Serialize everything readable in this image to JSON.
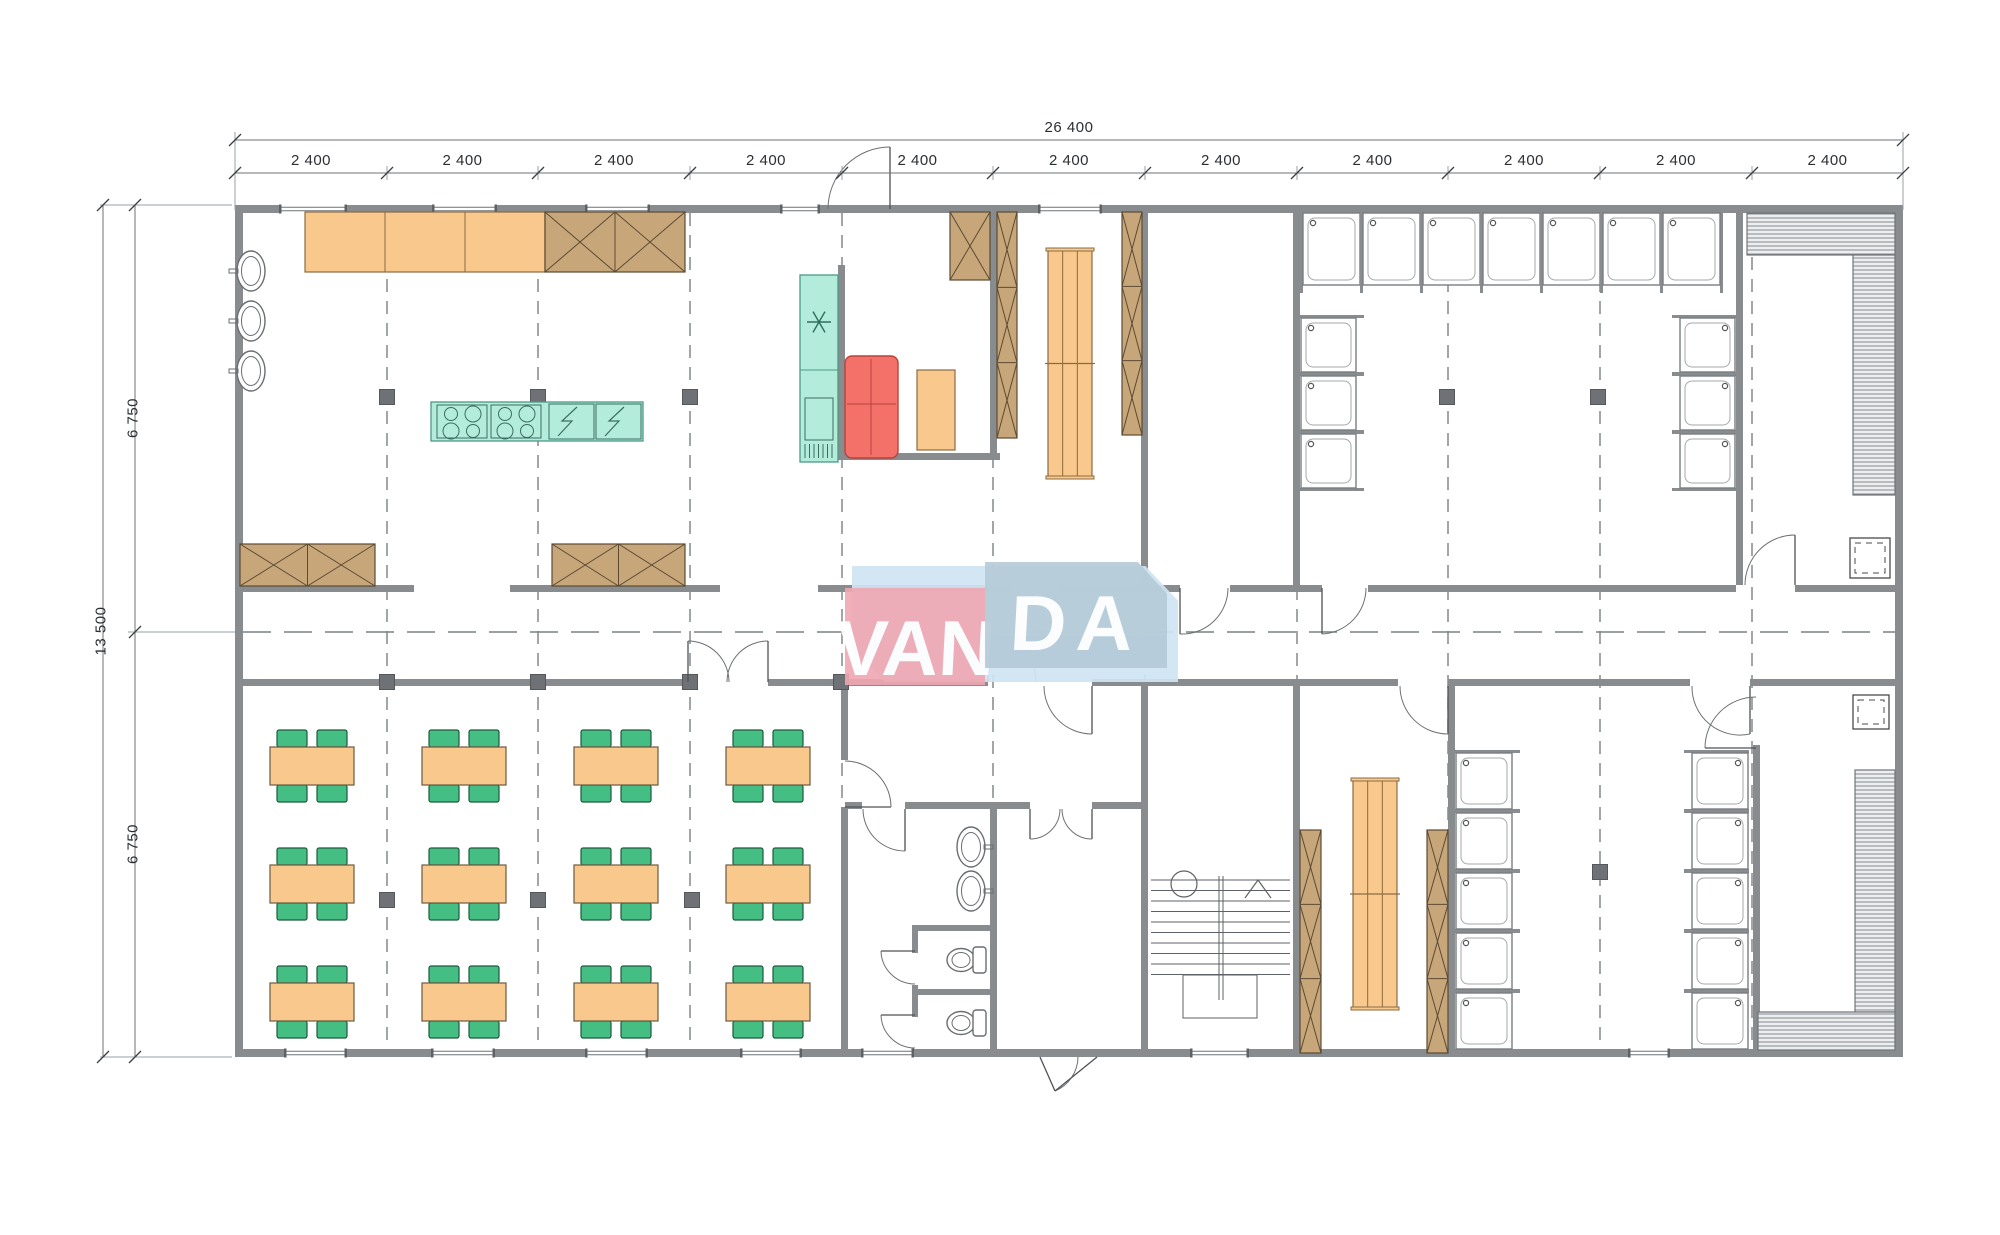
{
  "watermark": {
    "left": "VAN",
    "right": "DA"
  },
  "dimensions": {
    "top_total": "26 400",
    "top_segments": [
      "2 400",
      "2 400",
      "2 400",
      "2 400",
      "2 400",
      "2 400",
      "2 400",
      "2 400",
      "2 400",
      "2 400",
      "2 400"
    ],
    "left_total": "13 500",
    "left_segments": [
      "6 750",
      "6 750"
    ]
  },
  "colors": {
    "wall": "#888c8f",
    "line": "#5e6266",
    "dash": "#7c8084",
    "column": "#6e7276",
    "orange": "#f9c88c",
    "orange_stroke": "#8a6b42",
    "tan": "#c7a67a",
    "tan_stroke": "#5c4a33",
    "green": "#44be82",
    "green_stroke": "#1d5a3c",
    "teal": "#b4ecdc",
    "teal_stroke": "#4a9a85",
    "red": "#f4716a",
    "red_stroke": "#b5443c",
    "hatch_bg": "#eceeef",
    "hatch_line": "#85898d",
    "fixture": "#6a6e72"
  },
  "plan": {
    "building": [
      235,
      205,
      1668,
      852
    ],
    "grid_x": [
      387,
      538,
      690,
      842,
      993,
      1145,
      1297,
      1448,
      1600,
      1752
    ],
    "grid_ticks": [
      235,
      387,
      538,
      690,
      842,
      993,
      1145,
      1297,
      1448,
      1600,
      1752,
      1903
    ],
    "center_y": 632,
    "walls": [
      [
        235,
        205,
        1668,
        8
      ],
      [
        235,
        1049,
        1668,
        8
      ],
      [
        235,
        213,
        8,
        836
      ],
      [
        1895,
        213,
        8,
        836
      ],
      [
        243,
        585,
        171,
        7
      ],
      [
        510,
        585,
        210,
        7
      ],
      [
        818,
        585,
        192,
        7
      ],
      [
        1058,
        585,
        122,
        7
      ],
      [
        1230,
        585,
        92,
        7
      ],
      [
        1368,
        585,
        368,
        7
      ],
      [
        1795,
        585,
        100,
        7
      ],
      [
        243,
        679,
        445,
        7
      ],
      [
        768,
        679,
        220,
        7
      ],
      [
        1092,
        679,
        306,
        7
      ],
      [
        1448,
        679,
        242,
        7
      ],
      [
        1750,
        679,
        145,
        7
      ],
      [
        838,
        265,
        7,
        195
      ],
      [
        838,
        453,
        162,
        7
      ],
      [
        990,
        205,
        7,
        250
      ],
      [
        1141,
        213,
        7,
        372
      ],
      [
        1293,
        213,
        7,
        372
      ],
      [
        1736,
        213,
        7,
        372
      ],
      [
        841,
        686,
        7,
        74
      ],
      [
        841,
        807,
        7,
        242
      ],
      [
        1141,
        686,
        7,
        363
      ],
      [
        1293,
        686,
        7,
        363
      ],
      [
        1448,
        686,
        7,
        363
      ],
      [
        1753,
        745,
        7,
        304
      ],
      [
        845,
        802,
        17,
        7
      ],
      [
        905,
        802,
        125,
        7
      ],
      [
        1092,
        802,
        53,
        7
      ],
      [
        990,
        806,
        7,
        243
      ],
      [
        912,
        925,
        6,
        28
      ],
      [
        912,
        985,
        6,
        32
      ],
      [
        918,
        925,
        75,
        6
      ],
      [
        918,
        989,
        75,
        6
      ]
    ],
    "windows_top": [
      [
        281,
        64
      ],
      [
        434,
        61
      ],
      [
        587,
        61
      ],
      [
        782,
        36
      ],
      [
        1040,
        60
      ]
    ],
    "windows_bottom": [
      [
        286,
        59
      ],
      [
        433,
        60
      ],
      [
        587,
        59
      ],
      [
        742,
        58
      ],
      [
        863,
        49
      ],
      [
        1192,
        55
      ],
      [
        1630,
        38
      ]
    ],
    "columns": [
      [
        387,
        397
      ],
      [
        538,
        397
      ],
      [
        690,
        397
      ],
      [
        1447,
        397
      ],
      [
        1598,
        397
      ],
      [
        387,
        682
      ],
      [
        538,
        682
      ],
      [
        690,
        682
      ],
      [
        841,
        682
      ],
      [
        387,
        900
      ],
      [
        538,
        900
      ],
      [
        692,
        900
      ],
      [
        1600,
        872
      ]
    ],
    "doors": [
      [
        890,
        209,
        890,
        147,
        828,
        209
      ],
      [
        1058,
        588,
        1058,
        634,
        1012,
        588
      ],
      [
        1180,
        588,
        1180,
        634,
        1228,
        588
      ],
      [
        1322,
        588,
        1322,
        634,
        1366,
        588
      ],
      [
        1795,
        585,
        1795,
        535,
        1745,
        585
      ],
      [
        688,
        682,
        688,
        641,
        729,
        682
      ],
      [
        768,
        682,
        768,
        641,
        727,
        682
      ],
      [
        988,
        682,
        988,
        634,
        1036,
        682
      ],
      [
        1092,
        686,
        1092,
        734,
        1044,
        686
      ],
      [
        1448,
        686,
        1448,
        734,
        1400,
        686
      ],
      [
        1750,
        686,
        1750,
        734,
        1692,
        686
      ],
      [
        1756,
        748,
        1705,
        748,
        1756,
        697
      ],
      [
        905,
        809,
        905,
        851,
        863,
        809
      ],
      [
        1030,
        809,
        1030,
        839,
        1060,
        809
      ],
      [
        1092,
        809,
        1092,
        839,
        1062,
        809
      ],
      [
        845,
        807,
        891,
        807,
        845,
        761
      ],
      [
        1040,
        1057,
        1055,
        1091,
        1078,
        1057
      ],
      [
        1097,
        1057,
        1055,
        1091,
        null,
        null
      ],
      [
        915,
        951,
        881,
        951,
        915,
        984
      ],
      [
        915,
        1015,
        881,
        1015,
        915,
        1048
      ]
    ],
    "counter": {
      "rect": [
        305,
        212,
        240,
        60
      ],
      "dividers": [
        385,
        465
      ]
    },
    "xboxes": [
      [
        545,
        212,
        140,
        60,
        2,
        1
      ],
      [
        240,
        544,
        135,
        42,
        2,
        1
      ],
      [
        552,
        544,
        133,
        42,
        2,
        1
      ],
      [
        950,
        212,
        40,
        68,
        1,
        1
      ],
      [
        997,
        212,
        20,
        226,
        1,
        3
      ],
      [
        1122,
        212,
        20,
        223,
        1,
        3
      ],
      [
        1300,
        830,
        21,
        223,
        1,
        3
      ],
      [
        1427,
        830,
        21,
        223,
        1,
        3
      ]
    ],
    "benches": [
      [
        1048,
        250,
        44,
        227
      ],
      [
        1353,
        780,
        44,
        228
      ]
    ],
    "island": {
      "rect": [
        431,
        402,
        212,
        39
      ],
      "stoves": [
        437,
        491
      ],
      "stove_w": 50,
      "zigzags": [
        549,
        596
      ],
      "zig_w": 45
    },
    "fridge": {
      "rect": [
        800,
        275,
        38,
        187
      ],
      "split_y": 370
    },
    "red_unit": [
      845,
      356,
      53,
      102
    ],
    "pantry_table": [
      917,
      370,
      38,
      80
    ],
    "basins": [
      {
        "cx": 251,
        "cy": 271,
        "dir": "w"
      },
      {
        "cx": 251,
        "cy": 321,
        "dir": "w"
      },
      {
        "cx": 251,
        "cy": 371,
        "dir": "w"
      },
      {
        "cx": 971,
        "cy": 847,
        "dir": "e"
      },
      {
        "cx": 971,
        "cy": 891,
        "dir": "e"
      }
    ],
    "toilets": [
      {
        "cx": 961,
        "cy": 960
      },
      {
        "cx": 961,
        "cy": 1023
      }
    ],
    "showers": {
      "top_row": {
        "xs": [
          1303,
          1363,
          1423,
          1483,
          1543,
          1603,
          1663
        ],
        "y": 213,
        "w": 57,
        "h": 72,
        "dot": "tl",
        "open": "s"
      },
      "top_left": {
        "x": 1301,
        "ys": [
          318,
          376,
          434
        ],
        "w": 55,
        "h": 54,
        "dot": "tl",
        "open": "e"
      },
      "top_right": {
        "x": 1680,
        "ys": [
          318,
          376,
          434
        ],
        "w": 55,
        "h": 54,
        "dot": "tr",
        "open": "w"
      },
      "bot_left": {
        "x": 1456,
        "ys": [
          753,
          813,
          873,
          933,
          993
        ],
        "w": 56,
        "h": 56,
        "dot": "tl",
        "open": "e"
      },
      "bot_right": {
        "x": 1692,
        "ys": [
          753,
          813,
          873,
          933,
          993
        ],
        "w": 56,
        "h": 56,
        "dot": "tr",
        "open": "w"
      }
    },
    "sauna_benches": [
      [
        1747,
        213,
        148,
        42
      ],
      [
        1853,
        255,
        42,
        240
      ],
      [
        1855,
        770,
        40,
        242
      ],
      [
        1758,
        1012,
        137,
        38
      ]
    ],
    "heaters": [
      [
        1850,
        538,
        40,
        40
      ],
      [
        1853,
        695,
        36,
        34
      ]
    ],
    "tables": {
      "cols": [
        312,
        464,
        616,
        768
      ],
      "rows": [
        766,
        884,
        1002
      ],
      "w": 84,
      "h": 38,
      "chair_w": 30,
      "chair_h": 17
    },
    "stairs": {
      "x1": 1151,
      "x2": 1290,
      "top_y": 880,
      "steps": 10,
      "step_h": 10.5,
      "stringer_x": 1221,
      "landing": [
        1183,
        975,
        74,
        43
      ],
      "circle": [
        1184,
        884,
        13
      ],
      "arrow": [
        [
          1245,
          898
        ],
        [
          1258,
          880
        ],
        [
          1271,
          898
        ]
      ]
    }
  }
}
